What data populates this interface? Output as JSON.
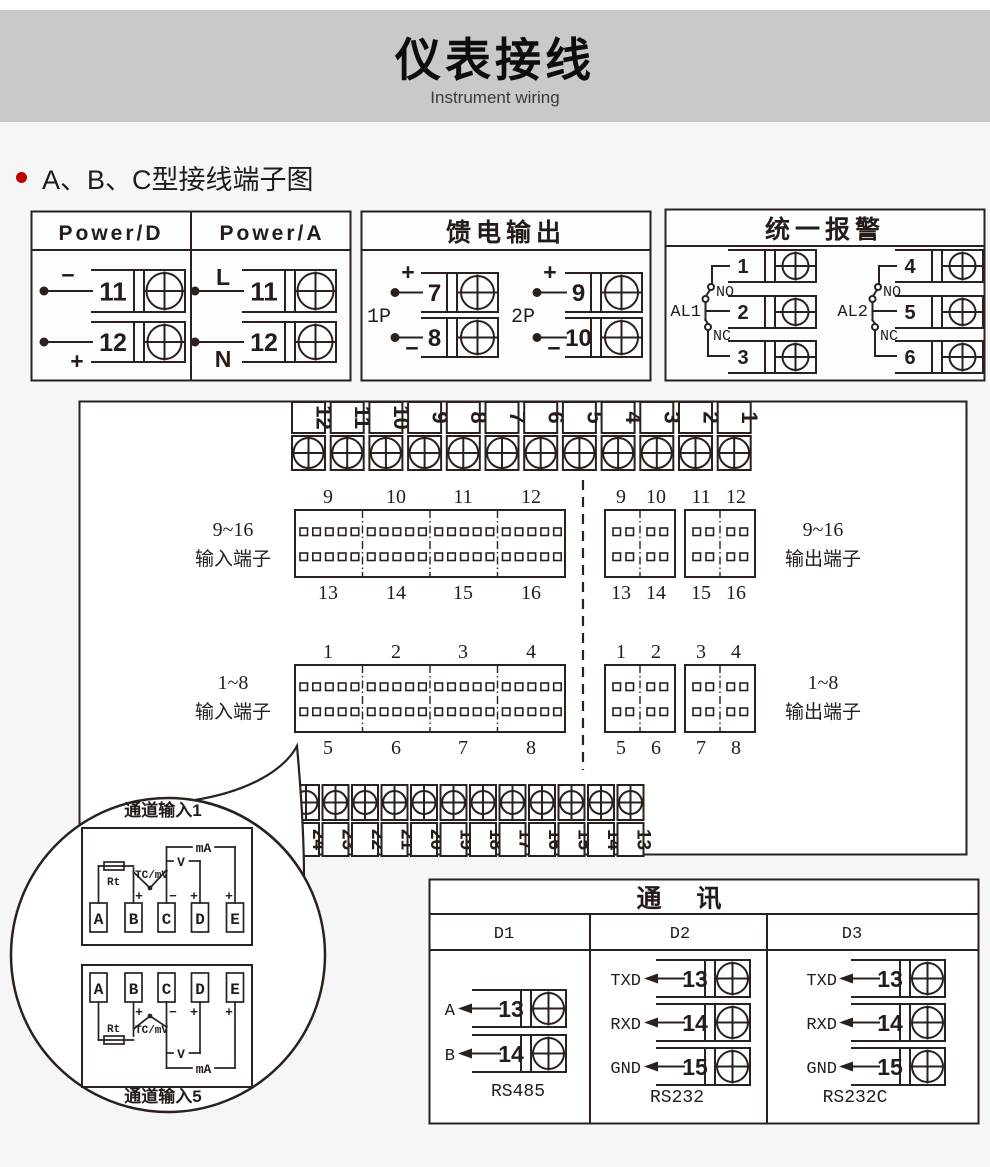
{
  "page": {
    "background": "#f6f6f6",
    "line_color": "#2a211c"
  },
  "header": {
    "title": "仪表接线",
    "subtitle": "Instrument wiring",
    "band_color": "#c9c9c9"
  },
  "section": {
    "heading": "A、B、C型接线端子图",
    "bullet_color": "#c00000"
  },
  "power_box": {
    "col_d": {
      "title": "Power/D",
      "t1": {
        "num": "11",
        "sign": "−"
      },
      "t2": {
        "num": "12",
        "sign": "+"
      }
    },
    "col_a": {
      "title": "Power/A",
      "t1": {
        "num": "11",
        "sign": "L"
      },
      "t2": {
        "num": "12",
        "sign": "N"
      }
    }
  },
  "feed_box": {
    "title": "馈电输出",
    "g1": {
      "label": "1P",
      "t1": {
        "num": "7",
        "sign": "+"
      },
      "t2": {
        "num": "8",
        "sign": "−"
      }
    },
    "g2": {
      "label": "2P",
      "t1": {
        "num": "9",
        "sign": "+"
      },
      "t2": {
        "num": "10",
        "sign": "−"
      }
    }
  },
  "alarm_box": {
    "title": "统一报警",
    "g1": {
      "label": "AL1",
      "no_label": "NO",
      "nc_label": "NC",
      "t1": "1",
      "t2": "2",
      "t3": "3"
    },
    "g2": {
      "label": "AL2",
      "no_label": "NO",
      "nc_label": "NC",
      "t1": "4",
      "t2": "5",
      "t3": "6"
    }
  },
  "main_board": {
    "top_strip": [
      "12",
      "11",
      "10",
      "9",
      "8",
      "7",
      "6",
      "5",
      "4",
      "3",
      "2",
      "1"
    ],
    "bottom_strip": [
      "24",
      "23",
      "22",
      "21",
      "20",
      "19",
      "18",
      "17",
      "16",
      "15",
      "14",
      "13"
    ],
    "input916": {
      "range": "9~16",
      "label": "输入端子",
      "top": [
        "9",
        "10",
        "11",
        "12"
      ],
      "bottom": [
        "13",
        "14",
        "15",
        "16"
      ]
    },
    "output916": {
      "range": "9~16",
      "label": "输出端子",
      "top": [
        "9",
        "10",
        "11",
        "12"
      ],
      "bottom": [
        "13",
        "14",
        "15",
        "16"
      ]
    },
    "input18": {
      "range": "1~8",
      "label": "输入端子",
      "top": [
        "1",
        "2",
        "3",
        "4"
      ],
      "bottom": [
        "5",
        "6",
        "7",
        "8"
      ]
    },
    "output18": {
      "range": "1~8",
      "label": "输出端子",
      "top": [
        "1",
        "2",
        "3",
        "4"
      ],
      "bottom": [
        "5",
        "6",
        "7",
        "8"
      ]
    }
  },
  "balloon": {
    "title_top": "通道输入1",
    "title_bottom": "通道输入5",
    "terminals": [
      "A",
      "B",
      "C",
      "D",
      "E"
    ],
    "rt": "Rt",
    "tc": "TC/mV",
    "v": "V",
    "ma": "mA",
    "plus": "+",
    "minus": "−"
  },
  "comm_box": {
    "title": "通 讯",
    "d1": {
      "header": "D1",
      "rows": [
        {
          "label": "A",
          "num": "13"
        },
        {
          "label": "B",
          "num": "14"
        }
      ],
      "footer": "RS485"
    },
    "d2": {
      "header": "D2",
      "rows": [
        {
          "label": "TXD",
          "num": "13"
        },
        {
          "label": "RXD",
          "num": "14"
        },
        {
          "label": "GND",
          "num": "15"
        }
      ],
      "footer": "RS232"
    },
    "d3": {
      "header": "D3",
      "rows": [
        {
          "label": "TXD",
          "num": "13"
        },
        {
          "label": "RXD",
          "num": "14"
        },
        {
          "label": "GND",
          "num": "15"
        }
      ],
      "footer": "RS232C"
    }
  }
}
